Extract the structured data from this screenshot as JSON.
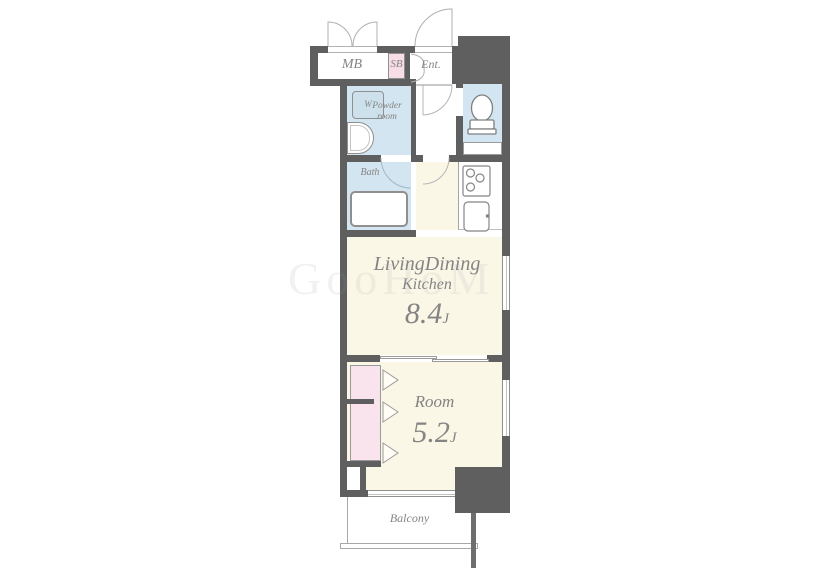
{
  "watermark": "GooHoM",
  "rooms": {
    "mb": {
      "label": "MB"
    },
    "sb": {
      "label": "SB"
    },
    "entrance": {
      "label": "Ent."
    },
    "washer": {
      "label": "W"
    },
    "powder": {
      "line1": "Powder",
      "line2": "room"
    },
    "bath": {
      "label": "Bath"
    },
    "ldk": {
      "line1": "LivingDining",
      "line2": "Kitchen",
      "size": "8.4",
      "unit": "J"
    },
    "room": {
      "label": "Room",
      "size": "5.2",
      "unit": "J"
    },
    "balcony": {
      "label": "Balcony"
    }
  },
  "colors": {
    "wall": "#5f5f5f",
    "wet_room_fill": "#d3e5f0",
    "living_fill": "#fbf7e6",
    "closet_fill": "#f9e4ee",
    "shoe_box_fill": "#f7dde6",
    "label_text": "#848484",
    "fixture_stroke": "#8f8f8f"
  }
}
